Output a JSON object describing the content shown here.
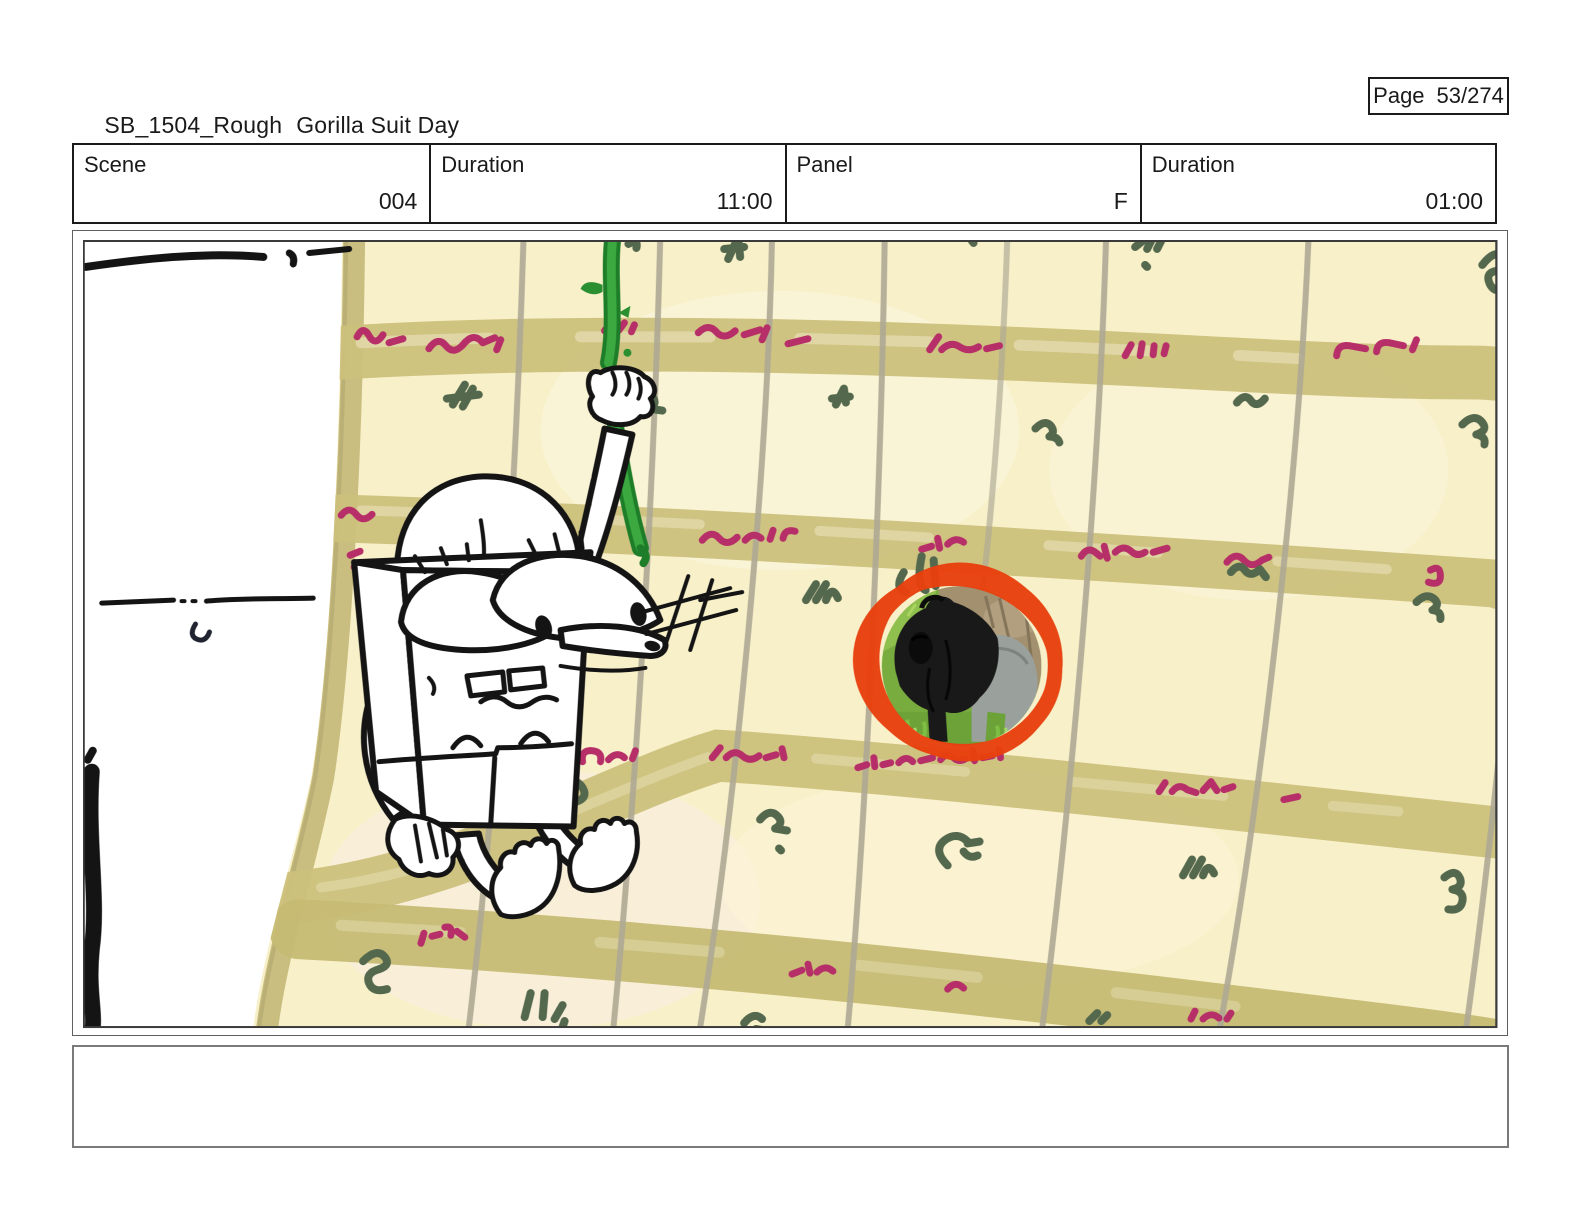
{
  "header": {
    "doc_title": "SB_1504_Rough",
    "doc_subtitle": "Gorilla Suit Day",
    "page_label": "Page",
    "page_value": "53/274"
  },
  "panel_meta": {
    "cells": [
      {
        "label": "Scene",
        "value": "004"
      },
      {
        "label": "Duration",
        "value": "11:00"
      },
      {
        "label": "Panel",
        "value": "F"
      },
      {
        "label": "Duration",
        "value": "01:00"
      }
    ]
  },
  "storyboard": {
    "description": "Rough storyboard panel: a sketched box-shaped cartoon character with droopy eyes hangs from a green vine in front of a giant calendar page covered in scribbled red and green writing; a photo of a silverback gorilla is circled in red-orange marker.",
    "annotation": "hand-drawn red marker circle around gorilla photo",
    "colors": {
      "paper_cream": "#F8F0C9",
      "calendar_band": "#CCC07C",
      "writing_red": "#B72F68",
      "writing_green": "#54684E",
      "vine_green": "#2FA139",
      "marker_red": "#E8400E",
      "ink_black": "#141414"
    }
  },
  "notes": {
    "text": ""
  }
}
